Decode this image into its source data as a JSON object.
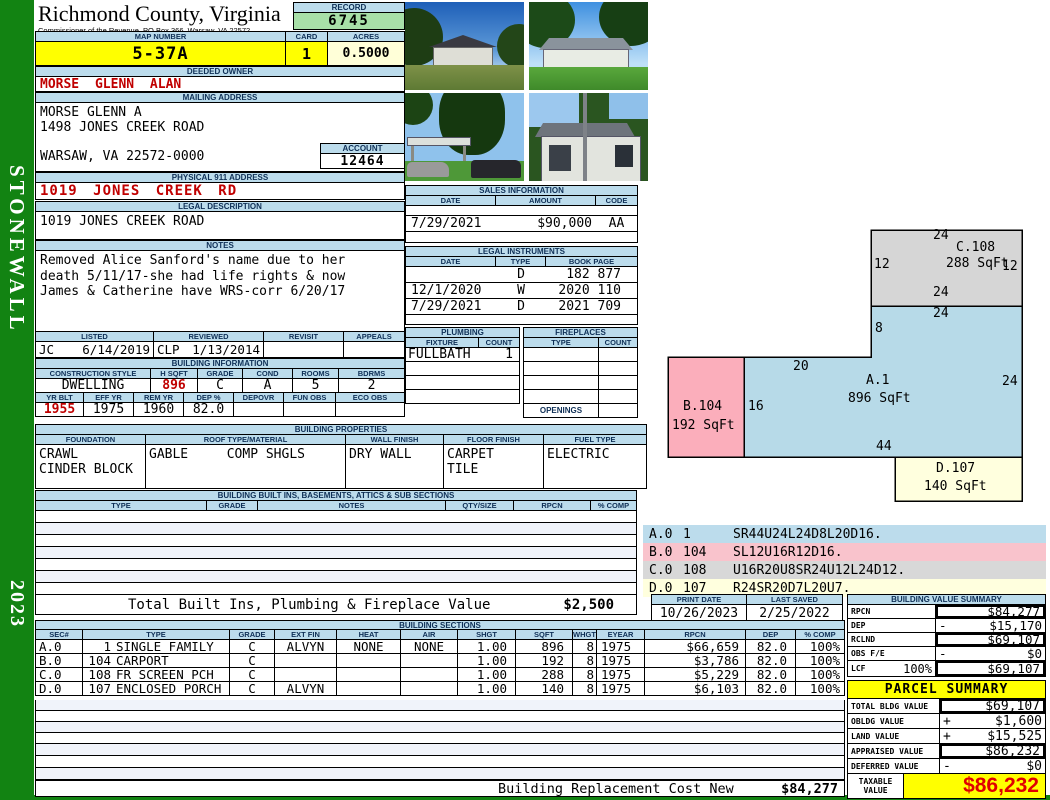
{
  "frame": {
    "sidebar_label": "STONEWALL",
    "year": "2023"
  },
  "header": {
    "county": "Richmond County, Virginia",
    "commissioner": "Commissioner of the Revenue, PO Box 366, Warsaw, VA 22572",
    "record_label": "RECORD",
    "record_number": "6745",
    "map_number_label": "MAP NUMBER",
    "map_number": "5-37A",
    "card_label": "CARD",
    "card": "1",
    "acres_label": "ACRES",
    "acres": "0.5000"
  },
  "owner": {
    "label": "DEEDED OWNER",
    "name": "MORSE GLENN ALAN"
  },
  "mailing": {
    "label": "MAILING ADDRESS",
    "line1": "MORSE GLENN A",
    "line2": "1498 JONES CREEK ROAD",
    "line3": "WARSAW, VA 22572-0000"
  },
  "account": {
    "label": "ACCOUNT",
    "number": "12464"
  },
  "physical": {
    "label": "PHYSICAL 911 ADDRESS",
    "address": "1019 JONES CREEK RD"
  },
  "legal": {
    "label": "LEGAL DESCRIPTION",
    "description": "1019 JONES CREEK ROAD"
  },
  "notes": {
    "label": "NOTES",
    "line1": "Removed Alice Sanford's name due to her",
    "line2": "death 5/11/17-she had life rights & now",
    "line3": "James & Catherine have WRS-corr 6/20/17"
  },
  "listing": {
    "listed_label": "LISTED",
    "listed_initials": "JC",
    "listed_date": "6/14/2019",
    "reviewed_label": "REVIEWED",
    "reviewed_initials": "CLP",
    "reviewed_date": "1/13/2014",
    "revisit_label": "REVISIT",
    "appeals_label": "APPEALS"
  },
  "building_info": {
    "title": "BUILDING INFORMATION",
    "headers1": [
      "CONSTRUCTION STYLE",
      "H SQFT",
      "GRADE",
      "COND",
      "ROOMS",
      "BDRMS"
    ],
    "values1": [
      "DWELLING",
      "896",
      "C",
      "A",
      "5",
      "2"
    ],
    "headers2": [
      "YR BLT",
      "EFF YR",
      "REM YR",
      "DEP %",
      "DEPOVR",
      "FUN OBS",
      "ECO OBS"
    ],
    "values2": [
      "1955",
      "1975",
      "1960",
      "82.0",
      "",
      "",
      ""
    ]
  },
  "building_properties": {
    "title": "BUILDING PROPERTIES",
    "headers": [
      "FOUNDATION",
      "ROOF TYPE/MATERIAL",
      "WALL FINISH",
      "FLOOR FINISH",
      "FUEL TYPE"
    ],
    "foundation1": "CRAWL",
    "foundation2": "CINDER BLOCK",
    "roof_type": "GABLE",
    "roof_material": "COMP SHGLS",
    "wall_finish": "DRY WALL",
    "floor_finish1": "CARPET",
    "floor_finish2": "TILE",
    "fuel_type": "ELECTRIC"
  },
  "built_ins": {
    "title": "BUILDING BUILT INS, BASEMENTS, ATTICS & SUB SECTIONS",
    "headers": [
      "TYPE",
      "GRADE",
      "NOTES",
      "QTY/SIZE",
      "RPCN",
      "% COMP"
    ],
    "total_label": "Total Built Ins, Plumbing & Fireplace Value",
    "total_value": "$2,500"
  },
  "sales": {
    "title": "SALES INFORMATION",
    "headers": [
      "DATE",
      "AMOUNT",
      "CODE"
    ],
    "date": "7/29/2021",
    "amount": "$90,000",
    "code": "AA"
  },
  "instruments": {
    "title": "LEGAL INSTRUMENTS",
    "headers": [
      "DATE",
      "TYPE",
      "BOOK PAGE"
    ],
    "rows": [
      {
        "date": "",
        "type": "D",
        "book_page": "182 877"
      },
      {
        "date": "12/1/2020",
        "type": "W",
        "book_page": "2020 110"
      },
      {
        "date": "7/29/2021",
        "type": "D",
        "book_page": "2021 709"
      }
    ]
  },
  "plumbing": {
    "title": "PLUMBING",
    "fixture_label": "FIXTURE",
    "count_label": "COUNT",
    "fixture": "FULLBATH",
    "count": "1"
  },
  "fireplaces": {
    "title": "FIREPLACES",
    "type_label": "TYPE",
    "count_label": "COUNT",
    "openings_label": "OPENINGS"
  },
  "sketch": {
    "a_label": "A.1",
    "a_sqft": "896 SqFt",
    "b_label": "B.104",
    "b_sqft": "192 SqFt",
    "c_label": "C.108",
    "c_sqft": "288 SqFt",
    "d_label": "D.107",
    "d_sqft": "140 SqFt",
    "dims": {
      "c_top": "24",
      "c_left": "12",
      "c_right": "12",
      "c_bottom": "24",
      "a_top": "24",
      "a_notch": "8",
      "a_seg": "20",
      "a_right": "24",
      "a_bottom": "44",
      "ab_shared": "16"
    },
    "legend": [
      {
        "sec": "A.0",
        "code": "1",
        "path": "SR44U24L24D8L20D16."
      },
      {
        "sec": "B.0",
        "code": "104",
        "path": "SL12U16R12D16."
      },
      {
        "sec": "C.0",
        "code": "108",
        "path": "U16R20U8SR24U12L24D12."
      },
      {
        "sec": "D.0",
        "code": "107",
        "path": "R24SR20D7L20U7."
      }
    ]
  },
  "print_info": {
    "print_date_label": "PRINT DATE",
    "print_date": "10/26/2023",
    "last_saved_label": "LAST SAVED",
    "last_saved": "2/25/2022"
  },
  "value_summary": {
    "title": "BUILDING VALUE SUMMARY",
    "rows": [
      {
        "label": "RPCN",
        "pct": "",
        "sign": "",
        "value": "$84,277"
      },
      {
        "label": "DEP",
        "pct": "",
        "sign": "-",
        "value": "$15,170"
      },
      {
        "label": "RCLND",
        "pct": "",
        "sign": "",
        "value": "$69,107"
      },
      {
        "label": "OBS F/E",
        "pct": "",
        "sign": "-",
        "value": "$0"
      },
      {
        "label": "LCF",
        "pct": "100%",
        "sign": "",
        "value": "$69,107"
      }
    ]
  },
  "sections": {
    "title": "BUILDING SECTIONS",
    "headers": [
      "SEC#",
      "TYPE",
      "GRADE",
      "EXT FIN",
      "HEAT",
      "AIR",
      "SHGT",
      "SQFT",
      "WHGT",
      "EYEAR",
      "RPCN",
      "DEP",
      "% COMP"
    ],
    "rows": [
      {
        "sec": "A.0",
        "code": "1",
        "type": "SINGLE FAMILY",
        "grade": "C",
        "ext_fin": "ALVYN",
        "heat": "NONE",
        "air": "NONE",
        "shgt": "1.00",
        "sqft": "896",
        "whgt": "8",
        "eyear": "1975",
        "rpcn": "$66,659",
        "dep": "82.0",
        "comp": "100%"
      },
      {
        "sec": "B.0",
        "code": "104",
        "type": "CARPORT",
        "grade": "C",
        "ext_fin": "",
        "heat": "",
        "air": "",
        "shgt": "1.00",
        "sqft": "192",
        "whgt": "8",
        "eyear": "1975",
        "rpcn": "$3,786",
        "dep": "82.0",
        "comp": "100%"
      },
      {
        "sec": "C.0",
        "code": "108",
        "type": "FR SCREEN PCH",
        "grade": "C",
        "ext_fin": "",
        "heat": "",
        "air": "",
        "shgt": "1.00",
        "sqft": "288",
        "whgt": "8",
        "eyear": "1975",
        "rpcn": "$5,229",
        "dep": "82.0",
        "comp": "100%"
      },
      {
        "sec": "D.0",
        "code": "107",
        "type": "ENCLOSED PORCH",
        "grade": "C",
        "ext_fin": "ALVYN",
        "heat": "",
        "air": "",
        "shgt": "1.00",
        "sqft": "140",
        "whgt": "8",
        "eyear": "1975",
        "rpcn": "$6,103",
        "dep": "82.0",
        "comp": "100%"
      }
    ]
  },
  "replacement": {
    "label": "Building Replacement Cost New",
    "value": "$84,277"
  },
  "parcel": {
    "title": "PARCEL SUMMARY",
    "rows": [
      {
        "label": "TOTAL BLDG VALUE",
        "sign": "",
        "value": "$69,107"
      },
      {
        "label": "OBLDG VALUE",
        "sign": "+",
        "value": "$1,600"
      },
      {
        "label": "LAND VALUE",
        "sign": "+",
        "value": "$15,525"
      },
      {
        "label": "APPRAISED VALUE",
        "sign": "",
        "value": "$86,232"
      },
      {
        "label": "DEFERRED VALUE",
        "sign": "-",
        "value": "$0"
      }
    ],
    "taxable_label1": "TAXABLE",
    "taxable_label2": "VALUE",
    "taxable_value": "$86,232"
  },
  "colors": {
    "header_blue": "#BCDCEC",
    "record_green": "#A8E0A8",
    "highlight_yellow": "#FFFF00",
    "cream": "#FFFFD8",
    "value_red": "#C00000",
    "sidebar_green": "#128312",
    "sketch_blue": "#B7DAE8",
    "sketch_pink": "#FBAEBB",
    "sketch_gray": "#D6D6D6",
    "sketch_cream": "#FFFFDE",
    "stripe": "#F0F3FA"
  }
}
